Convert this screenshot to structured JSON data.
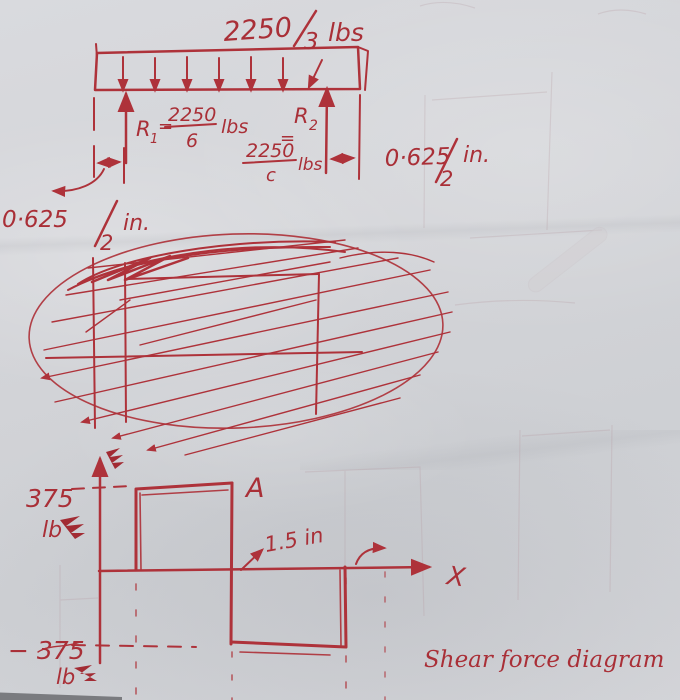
{
  "colors": {
    "ink": "#ae323a",
    "paper": "#d4d5d9"
  },
  "beam_diagram": {
    "load": {
      "num": "2250",
      "den": "3",
      "unit": "lbs"
    },
    "r1": {
      "name": "R",
      "sub": "1",
      "eq": "=",
      "num": "2250",
      "den": "6",
      "unit": "lbs"
    },
    "r2": {
      "name": "R",
      "sub": "2",
      "eq": "=",
      "num": "2250",
      "den": "c",
      "unit": "lbs"
    },
    "dim_left": {
      "num": "0·625",
      "den": "2",
      "unit": "in."
    },
    "dim_right": {
      "num": "0·625",
      "den": "2",
      "unit": "in."
    }
  },
  "shear_diagram": {
    "pos_value": "375",
    "pos_unit": "lb",
    "neg_value": "− 375",
    "neg_unit": "lb",
    "point_label": "A",
    "crossing_label": "1.5 in",
    "axis_label": "X",
    "caption": "Shear force diagram"
  },
  "chart_data": {
    "type": "line",
    "title": "Shear force diagram",
    "xlabel": "X",
    "ylabel": "Shear force (lb)",
    "x_units": "in",
    "series": [
      {
        "name": "shear",
        "step_x": [
          0,
          1.5,
          1.5,
          3
        ],
        "step_y": [
          375,
          375,
          -375,
          -375
        ]
      }
    ],
    "ylim": [
      -375,
      375
    ],
    "annotations": [
      "A",
      "1.5 in",
      "375 lb",
      "− 375 lb"
    ]
  }
}
